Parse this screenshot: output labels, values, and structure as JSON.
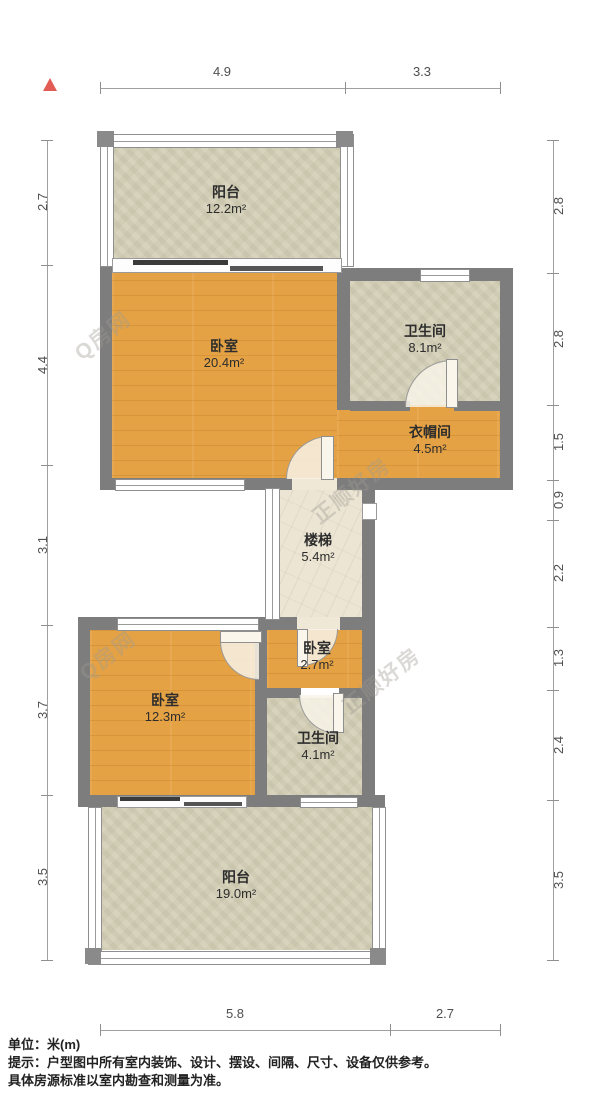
{
  "plan": {
    "unit_system_note": "米(m)"
  },
  "rooms": [
    {
      "id": "balcony-top",
      "name": "阳台",
      "area": "12.2m²"
    },
    {
      "id": "bedroom-master",
      "name": "卧室",
      "area": "20.4m²"
    },
    {
      "id": "bathroom-top",
      "name": "卫生间",
      "area": "8.1m²"
    },
    {
      "id": "cloakroom",
      "name": "衣帽间",
      "area": "4.5m²"
    },
    {
      "id": "stairs",
      "name": "楼梯",
      "area": "5.4m²"
    },
    {
      "id": "bedroom-mini",
      "name": "卧室",
      "area": "2.7m²"
    },
    {
      "id": "bedroom-second",
      "name": "卧室",
      "area": "12.3m²"
    },
    {
      "id": "bathroom-lower",
      "name": "卫生间",
      "area": "4.1m²"
    },
    {
      "id": "balcony-bottom",
      "name": "阳台",
      "area": "19.0m²"
    }
  ],
  "dimensions": {
    "top": [
      "4.9",
      "3.3"
    ],
    "bottom": [
      "5.8",
      "2.7"
    ],
    "left": [
      "2.7",
      "4.4",
      "3.1",
      "3.7",
      "3.5"
    ],
    "right": [
      "2.8",
      "2.8",
      "1.5",
      "0.9",
      "2.2",
      "1.3",
      "2.4",
      "3.5"
    ]
  },
  "watermarks": [
    "Q房网",
    "正顺好房"
  ],
  "footer": {
    "unit": "单位：米(m)",
    "note1": "提示：户型图中所有室内装饰、设计、摆设、间隔、尺寸、设备仅供参考。",
    "note2": "具体房源标准以室内勘查和测量为准。"
  },
  "colors": {
    "wall": "#7d7d7d",
    "wood_floor": "#e5a244",
    "tile_floor": "#d7d3bc",
    "stairs_floor": "#ece5d4",
    "north_arrow": "#e25b55"
  }
}
